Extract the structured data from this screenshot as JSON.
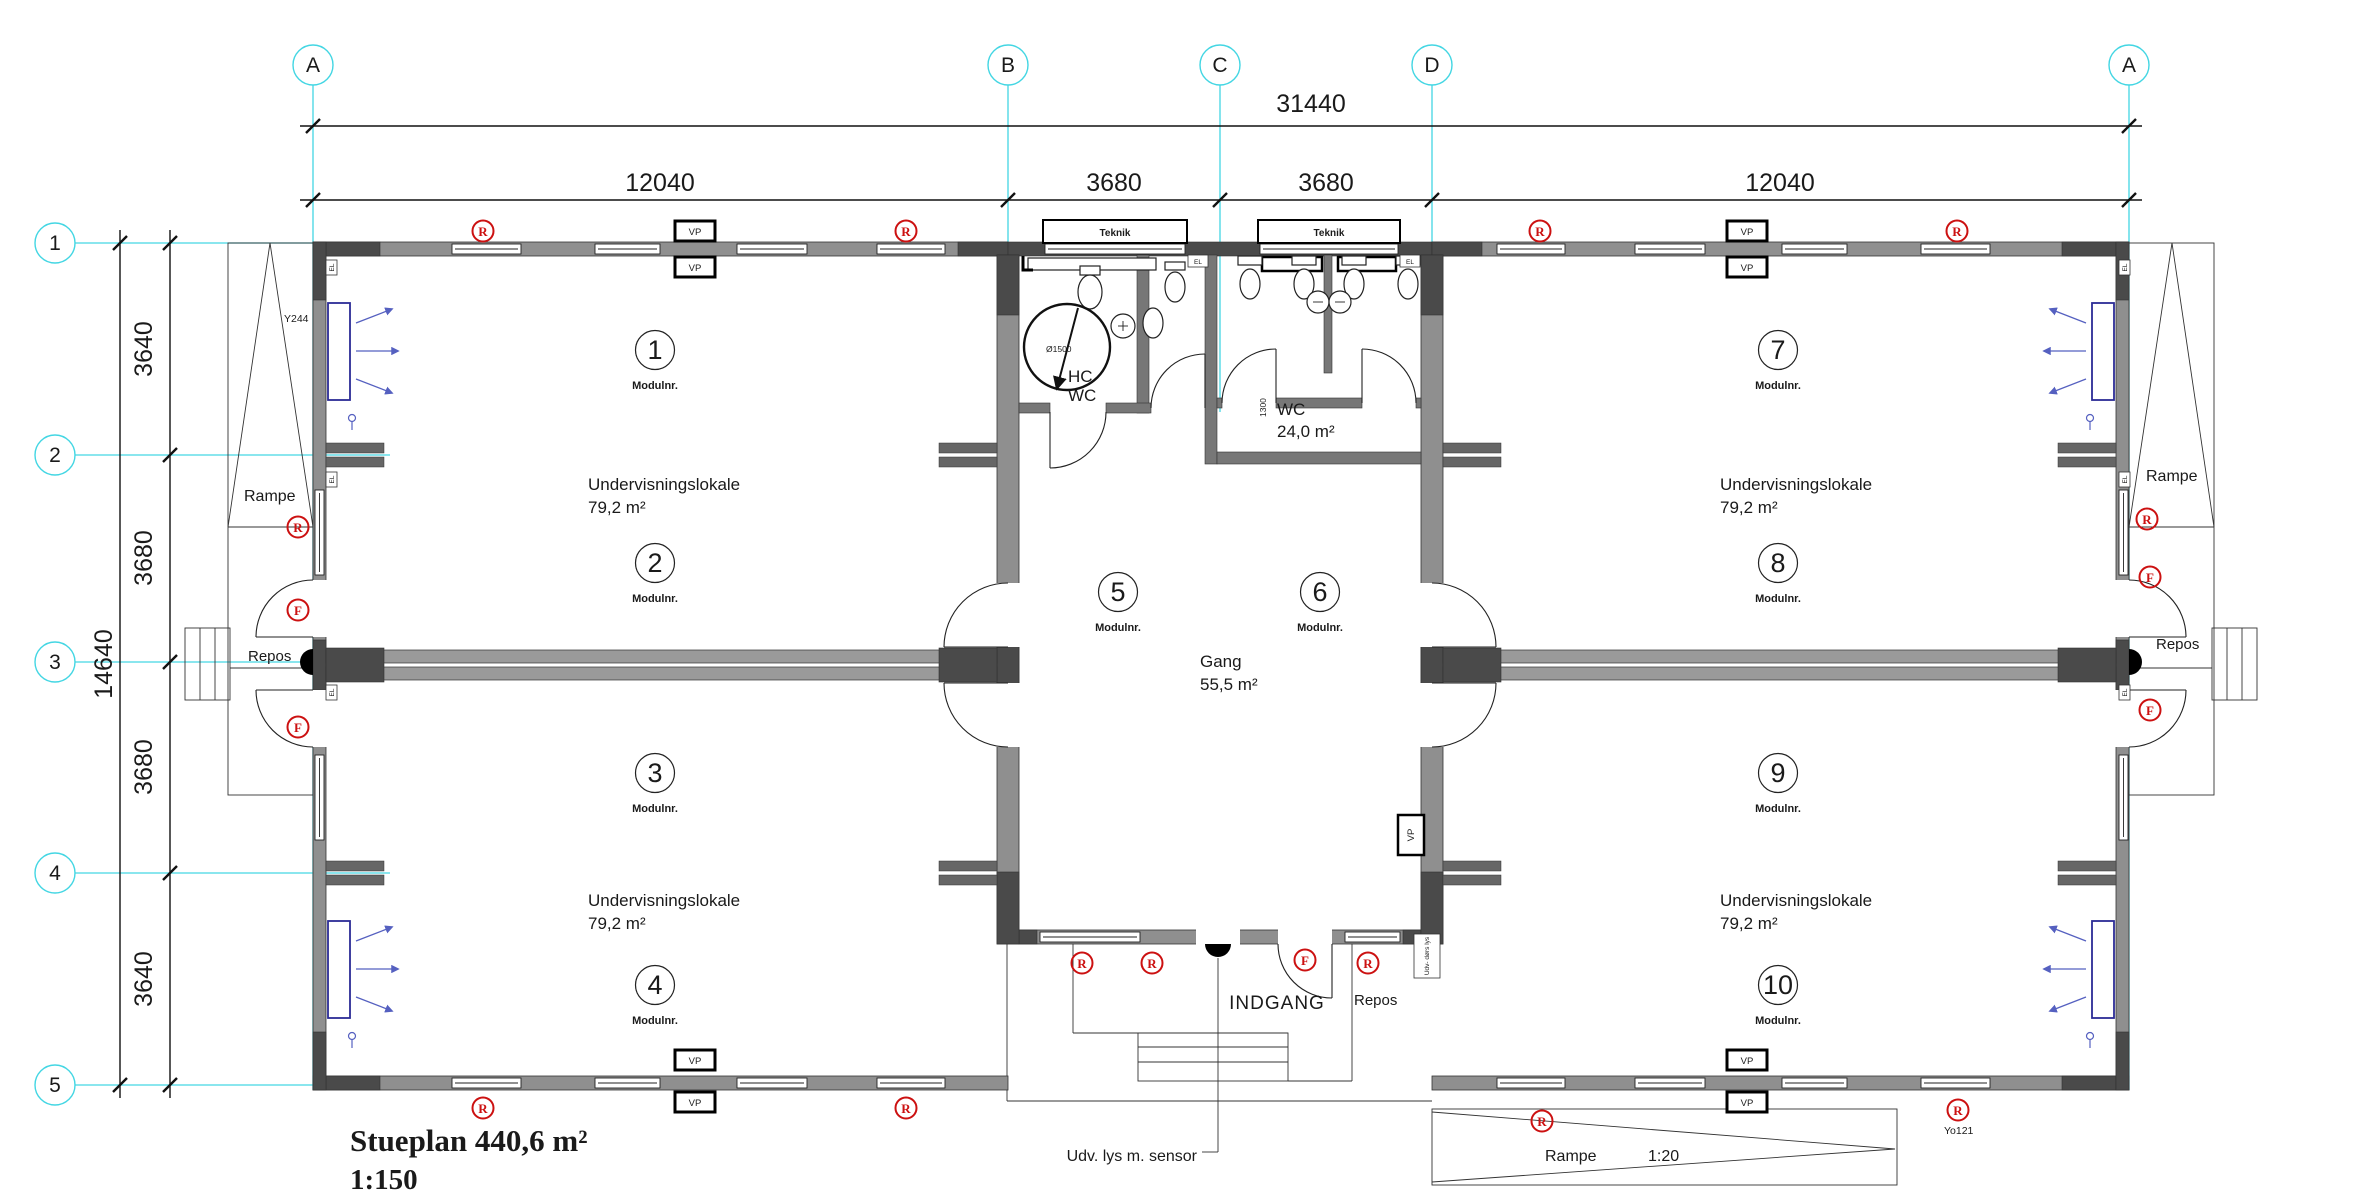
{
  "title": {
    "name": "Stueplan 440,6 m²",
    "scale": "1:150"
  },
  "grid": {
    "cols": [
      "A",
      "B",
      "C",
      "D",
      "A"
    ],
    "rows": [
      "1",
      "2",
      "3",
      "4",
      "5"
    ]
  },
  "dims": {
    "total_width": "31440",
    "top_spans": [
      "12040",
      "3680",
      "3680",
      "12040"
    ],
    "total_height": "14640",
    "left_spans": [
      "3640",
      "3680",
      "3680",
      "3640"
    ],
    "wc_depth": "1300",
    "turning_circle": "Ø1500"
  },
  "rooms": {
    "classroom": {
      "name": "Undervisningslokale",
      "area": "79,2 m²"
    },
    "gang": {
      "name": "Gang",
      "area": "55,5 m²"
    },
    "wc": {
      "name": "WC",
      "area": "24,0 m²"
    },
    "hcwc": {
      "line1": "HC",
      "line2": "WC"
    },
    "teknik": "Teknik"
  },
  "modules": {
    "caption": "Modulnr.",
    "numbers": [
      "1",
      "2",
      "3",
      "4",
      "5",
      "6",
      "7",
      "8",
      "9",
      "10"
    ]
  },
  "labels": {
    "rampe": "Rampe",
    "repos": "Repos",
    "indgang": "INDGANG",
    "udv_lys": "Udv. lys m. sensor",
    "ramp_slope": "1:20",
    "vp": "VP",
    "el": "EL",
    "y244": "Y244",
    "yo121": "Yo121",
    "udv_doors_lys": "Udv- dørs lys"
  },
  "symbols": {
    "r": "R",
    "f": "F"
  },
  "colors": {
    "grid_line": "#43d6e3",
    "symbol_red": "#cc1111",
    "board_blue": "#2b2b96",
    "wall_dark": "#4a4a4a",
    "wall_mid": "#8f8f8f",
    "wall_light": "#9a9a9a"
  }
}
